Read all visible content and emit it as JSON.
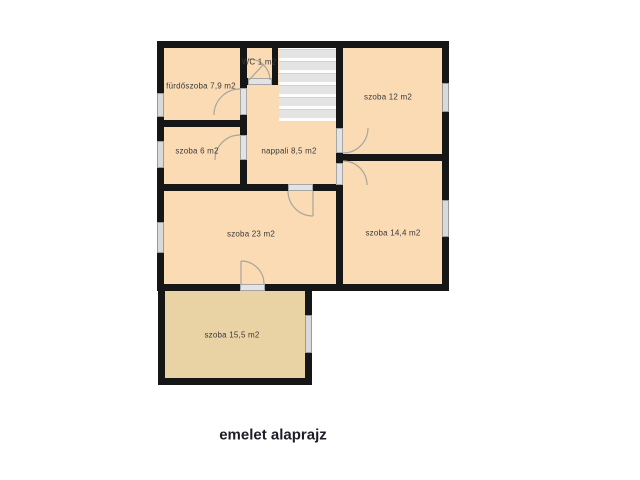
{
  "title": "emelet alaprajz",
  "colors": {
    "room_fill": "#fbdbb4",
    "extension_room_fill": "#e9d2a4",
    "wall": "#161616",
    "window_fill": "#d9d9d9",
    "door_fill": "#e3e3e3",
    "stair_tread": "#e4e4e4"
  },
  "rooms": [
    {
      "name": "fürdőszoba",
      "area": "7,9 m2",
      "label": "fürdőszoba 7,9 m2"
    },
    {
      "name": "WC",
      "area": "1 m2",
      "label": "WC 1 m2"
    },
    {
      "name": "szoba",
      "area": "12 m2",
      "label": "szoba 12 m2"
    },
    {
      "name": "szoba",
      "area": "6 m2",
      "label": "szoba 6 m2"
    },
    {
      "name": "nappali",
      "area": "8,5 m2",
      "label": "nappali 8,5 m2"
    },
    {
      "name": "szoba",
      "area": "23 m2",
      "label": "szoba 23 m2"
    },
    {
      "name": "szoba",
      "area": "14,4 m2",
      "label": "szoba 14,4 m2"
    },
    {
      "name": "szoba",
      "area": "15,5 m2",
      "label": "szoba 15,5 m2"
    }
  ]
}
